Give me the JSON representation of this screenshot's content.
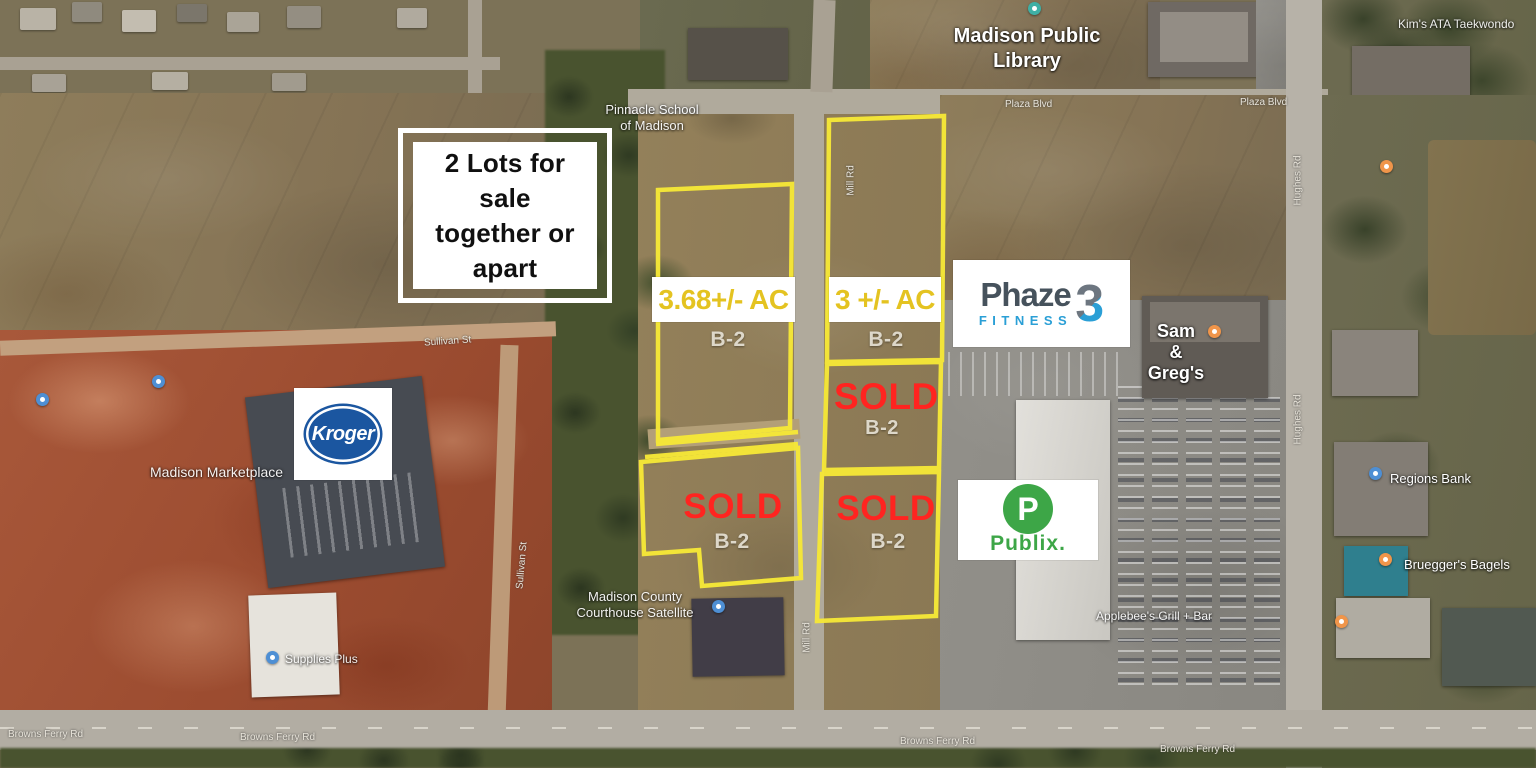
{
  "annotations": {
    "sale_note_lines": [
      "2 Lots for",
      "sale",
      "together or",
      "apart"
    ],
    "lot_a": {
      "acreage": "3.68+/- AC",
      "zoning": "B-2"
    },
    "lot_b": {
      "acreage": "3 +/- AC",
      "zoning": "B-2"
    },
    "sold_upper": {
      "status": "SOLD",
      "zoning": "B-2"
    },
    "sold_lower_left": {
      "status": "SOLD",
      "zoning": "B-2"
    },
    "sold_lower_right": {
      "status": "SOLD",
      "zoning": "B-2"
    },
    "colors": {
      "lot_outline": "#f6e837",
      "acreage_text": "#e4c321",
      "sold_text": "#ff2420"
    }
  },
  "logos": {
    "kroger": {
      "text": "Kroger",
      "blue": "#1b56a0"
    },
    "phaze3": {
      "word": "Phaze",
      "digit": "3",
      "sub": "FITNESS",
      "blue": "#2a9fd6"
    },
    "publix": {
      "initial": "P",
      "text": "Publix.",
      "green": "#3da647"
    }
  },
  "map_labels": {
    "library_line1": "Madison Public",
    "library_line2": "Library",
    "taekwondo": "Kim's ATA Taekwondo",
    "school_line1": "Pinnacle School",
    "school_line2": "of Madison",
    "marketplace": "Madison Marketplace",
    "sam": "Sam",
    "ampersand": "&",
    "gregs": "Greg's",
    "courthouse_line1": "Madison County",
    "courthouse_line2": "Courthouse Satellite",
    "supplies": "Supplies Plus",
    "regions_bank": "Regions Bank",
    "brueggers": "Bruegger's Bagels",
    "applebees": "Applebee's Grill + Bar"
  },
  "road_labels": {
    "plaza": "Plaza Blvd",
    "browns_ferry": "Browns Ferry Rd",
    "hughes": "Hughes Rd",
    "mill": "Mill Rd",
    "sullivan": "Sullivan St"
  }
}
